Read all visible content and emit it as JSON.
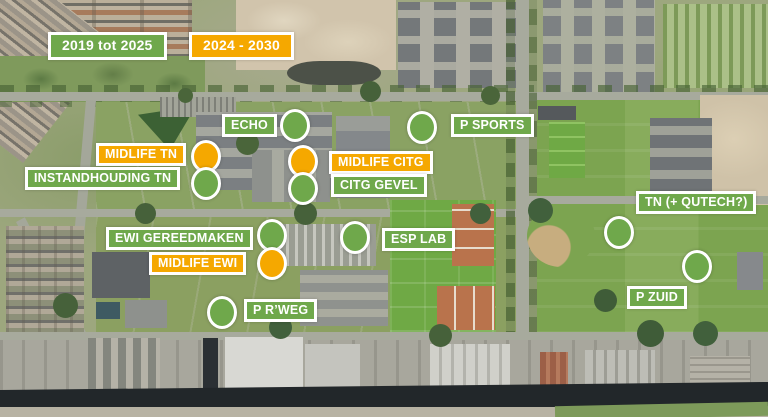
{
  "colors": {
    "green": "#6FA84B",
    "orange": "#F5A800",
    "label_text": "#FFFFFF",
    "label_border": "#FFFFFF",
    "marker_border": "#FFFFFF"
  },
  "legend": {
    "existing_period": "2019 tot 2025",
    "future_period": "2024 - 2030"
  },
  "annotations": {
    "labels": [
      {
        "id": "legend-2019",
        "text": "2019 tot 2025",
        "color": "green",
        "legend": true,
        "x": 48,
        "y": 32
      },
      {
        "id": "legend-2024",
        "text": "2024 - 2030",
        "color": "orange",
        "legend": true,
        "x": 189,
        "y": 32
      },
      {
        "id": "echo",
        "text": "ECHO",
        "color": "green",
        "x": 222,
        "y": 114
      },
      {
        "id": "p-sports",
        "text": "P SPORTS",
        "color": "green",
        "x": 451,
        "y": 114
      },
      {
        "id": "midlife-tn",
        "text": "MIDLIFE TN",
        "color": "orange",
        "x": 96,
        "y": 143
      },
      {
        "id": "instandhouding-tn",
        "text": "INSTANDHOUDING TN",
        "color": "green",
        "x": 25,
        "y": 167
      },
      {
        "id": "midlife-citg",
        "text": "MIDLIFE CITG",
        "color": "orange",
        "x": 329,
        "y": 151
      },
      {
        "id": "citg-gevel",
        "text": "CITG GEVEL",
        "color": "green",
        "x": 331,
        "y": 174
      },
      {
        "id": "tn-qutech",
        "text": "TN (+ QUTECH?)",
        "color": "green",
        "x": 636,
        "y": 191
      },
      {
        "id": "ewi-gereedmaken",
        "text": "EWI GEREEDMAKEN",
        "color": "green",
        "x": 106,
        "y": 227
      },
      {
        "id": "midlife-ewi",
        "text": "MIDLIFE EWI",
        "color": "orange",
        "x": 149,
        "y": 252
      },
      {
        "id": "esp-lab",
        "text": "ESP LAB",
        "color": "green",
        "x": 382,
        "y": 228
      },
      {
        "id": "p-zuid",
        "text": "P ZUID",
        "color": "green",
        "x": 627,
        "y": 286
      },
      {
        "id": "p-rweg",
        "text": "P R’WEG",
        "color": "green",
        "x": 244,
        "y": 299
      }
    ],
    "markers": [
      {
        "id": "echo",
        "color": "green",
        "cx": 295,
        "cy": 125
      },
      {
        "id": "p-sports",
        "color": "green",
        "cx": 422,
        "cy": 127
      },
      {
        "id": "midlife-tn",
        "color": "orange",
        "cx": 206,
        "cy": 156
      },
      {
        "id": "instandhouding-tn",
        "color": "green",
        "cx": 206,
        "cy": 183
      },
      {
        "id": "midlife-citg",
        "color": "orange",
        "cx": 303,
        "cy": 161
      },
      {
        "id": "citg-gevel",
        "color": "green",
        "cx": 303,
        "cy": 188
      },
      {
        "id": "ewi-gereedmaken",
        "color": "green",
        "cx": 272,
        "cy": 235
      },
      {
        "id": "midlife-ewi",
        "color": "orange",
        "cx": 272,
        "cy": 263
      },
      {
        "id": "esp-lab",
        "color": "green",
        "cx": 355,
        "cy": 237
      },
      {
        "id": "p-rweg",
        "color": "green",
        "cx": 222,
        "cy": 312
      },
      {
        "id": "tn-qutech",
        "color": "green",
        "cx": 619,
        "cy": 232
      },
      {
        "id": "p-zuid",
        "color": "green",
        "cx": 697,
        "cy": 266
      }
    ]
  }
}
